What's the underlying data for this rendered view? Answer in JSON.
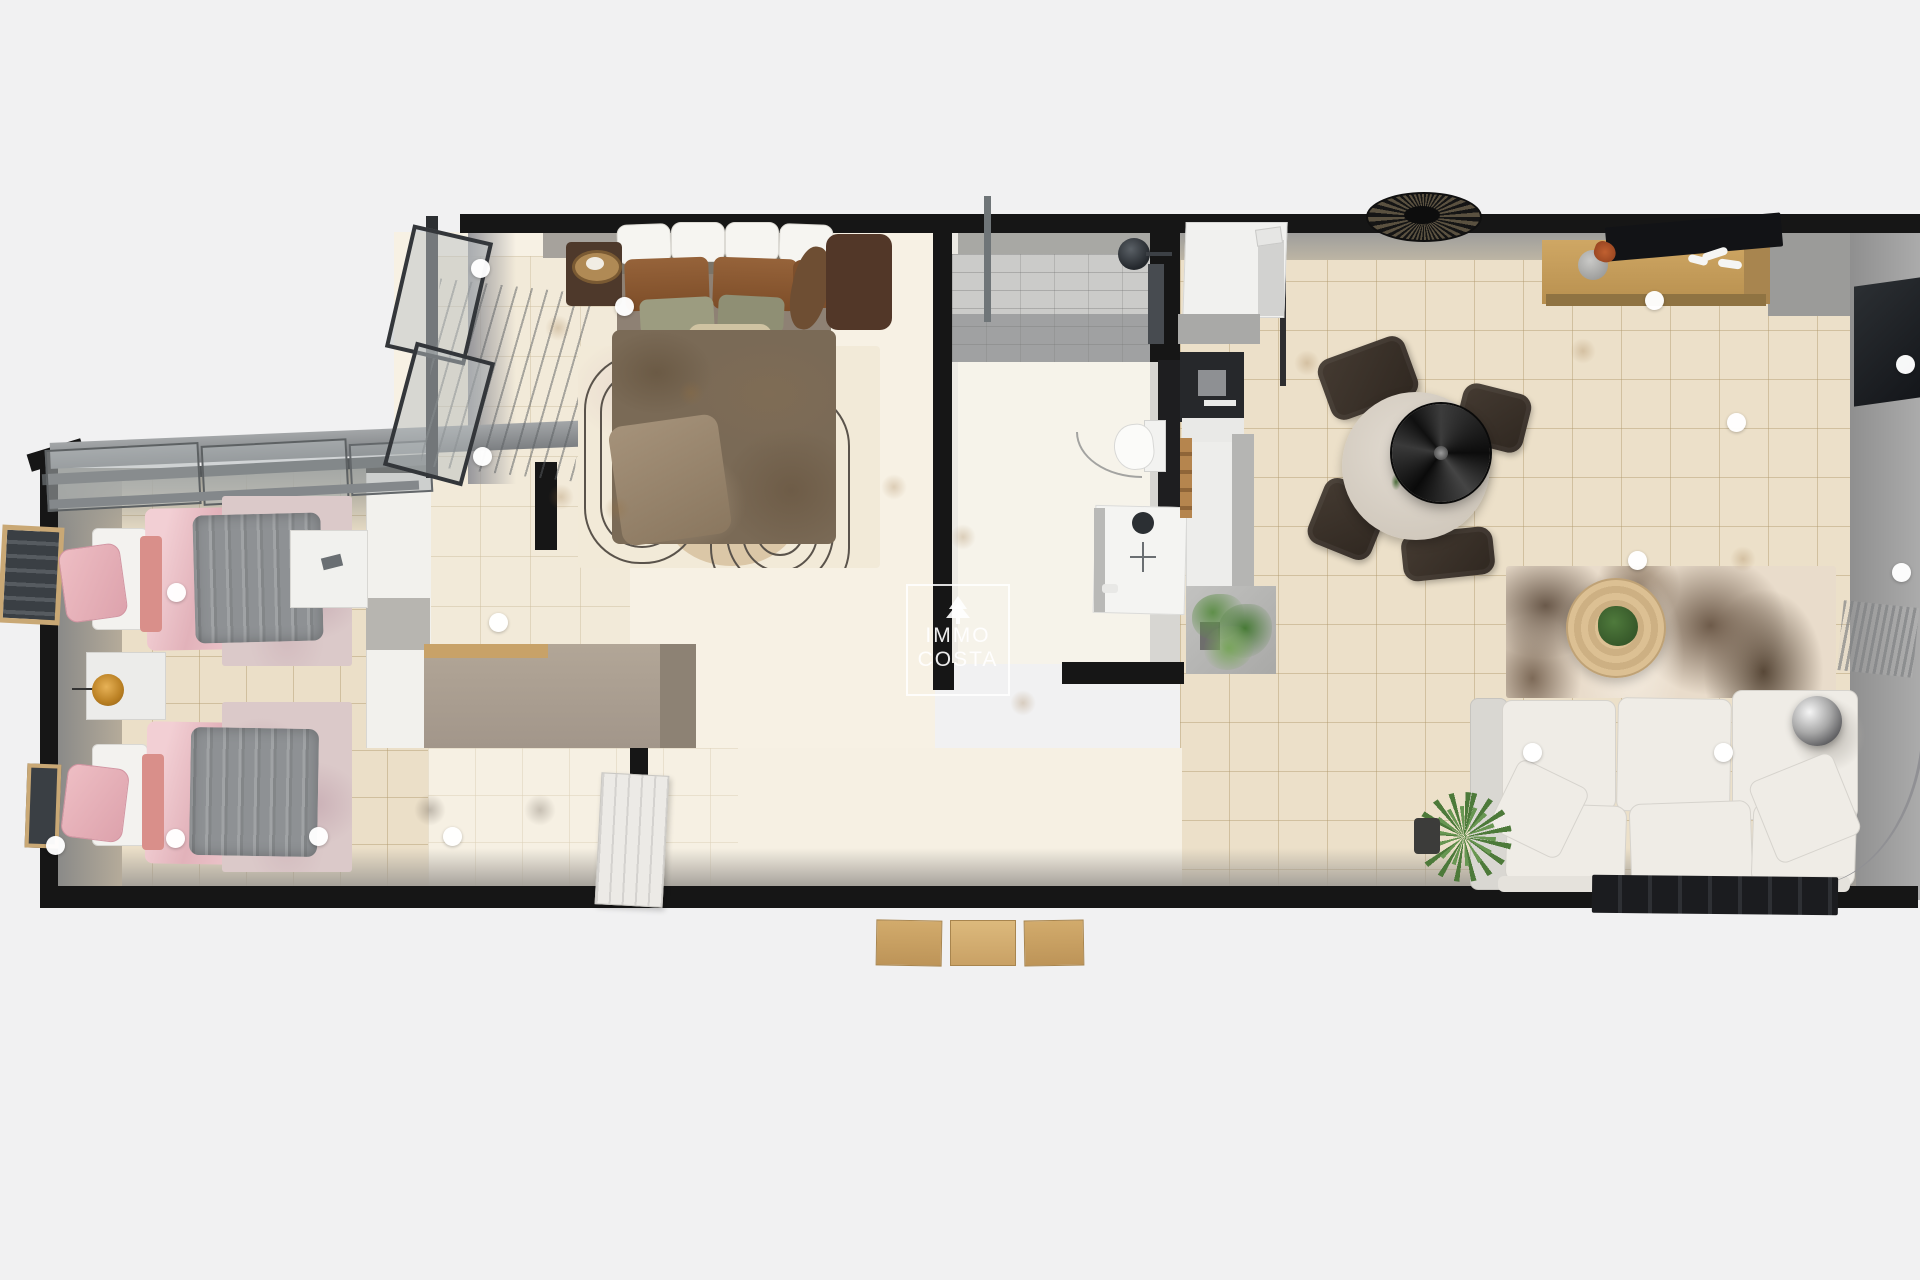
{
  "watermark": {
    "icon": "pine-tree-icon",
    "line1": "IMMO",
    "line2": "COSTA"
  },
  "palette": {
    "bg": "#f1f1f2",
    "wall": "#161616",
    "tile": "#ece0c9",
    "tile_line": "rgba(176,152,108,0.45)",
    "cream": "#f7f1e4",
    "duvet": "#8e9194",
    "pink_deep": "#d98f8a",
    "bed_brown": "#7a6a56",
    "sofa": "#efece6",
    "wood": "#c49a5e",
    "hotspot": "#ffffff"
  },
  "hotspots": [
    {
      "x": 176,
      "y": 592
    },
    {
      "x": 55,
      "y": 845
    },
    {
      "x": 175,
      "y": 838
    },
    {
      "x": 318,
      "y": 836
    },
    {
      "x": 452,
      "y": 836
    },
    {
      "x": 480,
      "y": 268
    },
    {
      "x": 482,
      "y": 456
    },
    {
      "x": 498,
      "y": 622
    },
    {
      "x": 624,
      "y": 306
    },
    {
      "x": 1654,
      "y": 300
    },
    {
      "x": 1736,
      "y": 422
    },
    {
      "x": 1637,
      "y": 560
    },
    {
      "x": 1905,
      "y": 364
    },
    {
      "x": 1901,
      "y": 572
    },
    {
      "x": 1532,
      "y": 752
    },
    {
      "x": 1723,
      "y": 752
    }
  ],
  "scene": {
    "type": "3d-floorplan-top-down-render",
    "rooms": [
      {
        "name": "kids-bedroom",
        "furniture": [
          "single-bed-pink-gray",
          "single-bed-pink-gray",
          "nightstand-with-lamp",
          "desk",
          "two-rugs",
          "slanted-window-wall",
          "wall-frames"
        ]
      },
      {
        "name": "master-bedroom",
        "furniture": [
          "double-bed-brown-linen",
          "nightstand-left-with-tray",
          "nightstand-right",
          "arc-pattern-rug",
          "taupe-dresser",
          "tall-window",
          "panel-door"
        ]
      },
      {
        "name": "bathroom",
        "furniture": [
          "walk-in-shower",
          "shower-glass",
          "toilet",
          "washbasin-vanity",
          "door-swing-arc"
        ]
      },
      {
        "name": "kitchen",
        "furniture": [
          "tall-fridge-unit",
          "black-oven-column",
          "countertop",
          "step-ladder",
          "potted-plant-on-mat"
        ]
      },
      {
        "name": "living-dining-room",
        "furniture": [
          "rattan-ceiling-lamp",
          "wooden-sideboard",
          "flat-tv",
          "decor-vase",
          "decor-coral",
          "dark-wall-cabinet",
          "round-dining-table",
          "black-pendant-lamp",
          "dining-chairs-x4",
          "round-coffee-table",
          "abstract-area-rug",
          "cream-sofa",
          "throw-pillows",
          "chrome-globe-floor-lamp",
          "potted-plant",
          "dark-slatted-bench",
          "sheer-curtain",
          "entrance-mats-x3"
        ]
      }
    ]
  }
}
